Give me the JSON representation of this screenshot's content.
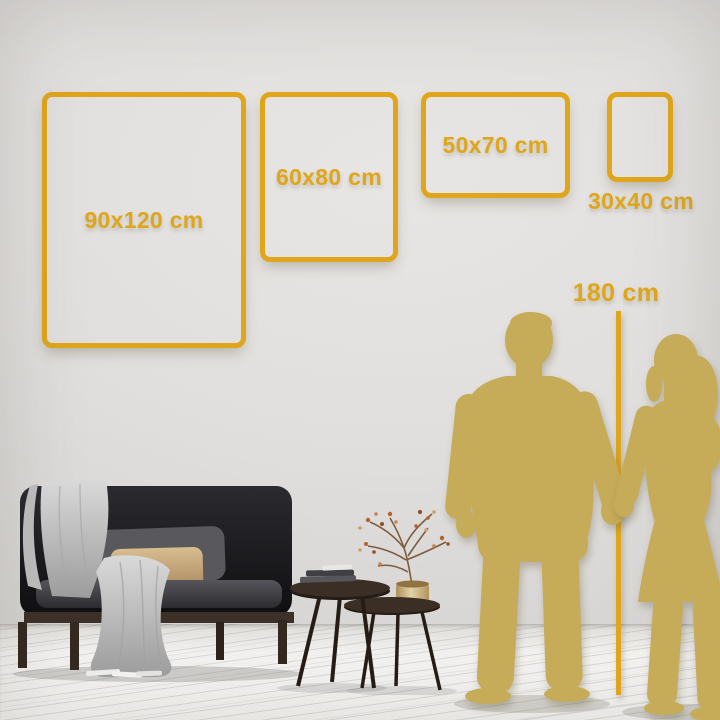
{
  "size_guide": {
    "frames": [
      {
        "label": "90x120 cm",
        "width_cm": 90,
        "height_cm": 120,
        "orientation": "portrait",
        "label_position": "inside"
      },
      {
        "label": "60x80 cm",
        "width_cm": 60,
        "height_cm": 80,
        "orientation": "portrait",
        "label_position": "inside"
      },
      {
        "label": "50x70 cm",
        "width_cm": 50,
        "height_cm": 70,
        "orientation": "landscape",
        "label_position": "inside"
      },
      {
        "label": "30x40 cm",
        "width_cm": 30,
        "height_cm": 40,
        "orientation": "portrait",
        "label_position": "below"
      }
    ],
    "height_reference": {
      "label": "180 cm",
      "value_cm": 180
    }
  },
  "scene": {
    "silhouettes": [
      {
        "name": "man-silhouette"
      },
      {
        "name": "woman-silhouette"
      }
    ],
    "furniture": [
      "black-sofa",
      "throw-blanket",
      "gray-pillow",
      "tan-pillow",
      "nesting-coffee-tables",
      "books",
      "brass-vase",
      "dried-branch-plant"
    ]
  },
  "colors": {
    "accent_gold": "#dfa61c",
    "silhouette_gold": "#c6ac58",
    "wall_gray": "#e1dfdd",
    "floor_white": "#f4f3f1",
    "sofa_black": "#17171a",
    "pillow_tan": "#c7a87c",
    "blanket_gray": "#c6c6c6",
    "wood_brown": "#3a2f26"
  }
}
